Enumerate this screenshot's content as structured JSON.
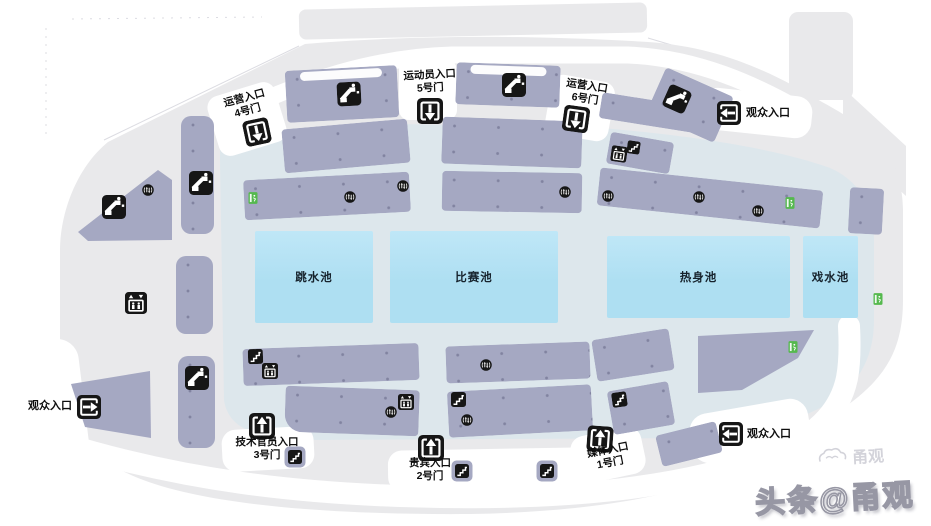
{
  "colors": {
    "base": "#e9e9eb",
    "concourse": "#dde7ec",
    "block": "#a5a8c2",
    "pool": "#aedff2",
    "icon": "#161616",
    "exit": "#55b94e",
    "label": "#0d0d0d"
  },
  "pools": {
    "diving": "跳水池",
    "competition": "比赛池",
    "warmup": "热身池",
    "play": "戏水池"
  },
  "labels": {
    "gate4": "运营入口\n4号门",
    "gate5": "运动员入口\n5号门",
    "gate6": "运营入口\n6号门",
    "spectator_top_right": "观众入口",
    "spectator_left": "观众入口",
    "gate3": "技术官员入口\n3号门",
    "gate2": "贵宾入口\n2号门",
    "gate1": "媒体入口\n1号门",
    "spectator_bottom_right": "观众入口"
  },
  "watermark": {
    "text": "头条@甬观",
    "logo_text": "甬观"
  }
}
